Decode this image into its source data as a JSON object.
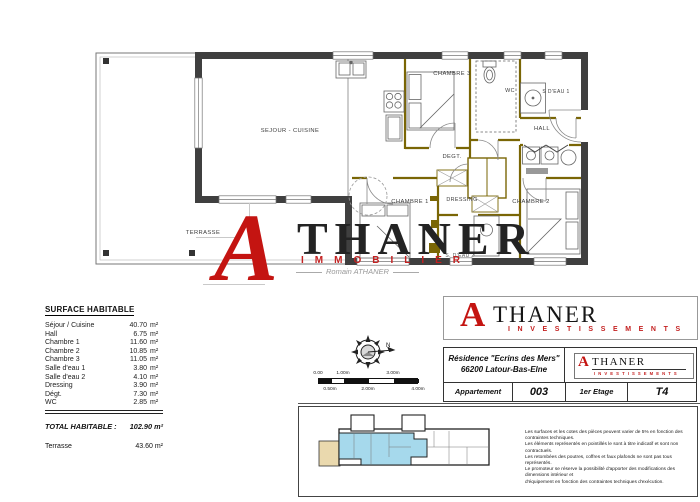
{
  "colors": {
    "accent_red": "#c41411",
    "wall_dark": "#3f3f3f",
    "joinery_gold": "#7a6605",
    "site_plan_blue": "#a6d9ec",
    "site_plan_tan": "#ead9ae"
  },
  "plan": {
    "rooms": {
      "sejour": "SEJOUR - CUISINE",
      "terrasse": "TERRASSE",
      "chambre1": "CHAMBRE 1",
      "chambre2": "CHAMBRE 2",
      "chambre3": "CHAMBRE 3",
      "wc": "WC",
      "sdeau1": "S D'EAU 1",
      "sdeau2": "S. D'EAU 2",
      "hall": "HALL",
      "degt": "DEGT.",
      "dressing": "DRESSING"
    }
  },
  "watermark": {
    "initial": "A",
    "name_rest": "THANER",
    "tagline": "IMMOBILIER",
    "byline": "Romain ATHANER"
  },
  "surface_table": {
    "title": "SURFACE HABITABLE",
    "rows": [
      {
        "label": "Séjour / Cuisine",
        "value": "40.70",
        "unit": "m²"
      },
      {
        "label": "Hall",
        "value": "6.75",
        "unit": "m²"
      },
      {
        "label": "Chambre 1",
        "value": "11.60",
        "unit": "m²"
      },
      {
        "label": "Chambre 2",
        "value": "10.85",
        "unit": "m²"
      },
      {
        "label": "Chambre 3",
        "value": "11.05",
        "unit": "m²"
      },
      {
        "label": "Salle d'eau 1",
        "value": "3.80",
        "unit": "m²"
      },
      {
        "label": "Salle d'eau 2",
        "value": "4.10",
        "unit": "m²"
      },
      {
        "label": "Dressing",
        "value": "3.90",
        "unit": "m²"
      },
      {
        "label": "Dégt.",
        "value": "7.30",
        "unit": "m²"
      },
      {
        "label": "WC",
        "value": "2.85",
        "unit": "m²"
      }
    ],
    "total_label": "TOTAL HABITABLE :",
    "total_value": "102.90 m²",
    "terrace_label": "Terrasse",
    "terrace_value": "43.60 m²"
  },
  "compass": {
    "north": "N"
  },
  "scale_bar": {
    "top_labels": [
      "0.00",
      "1.00m",
      "3.00m"
    ],
    "bottom_labels": [
      "0.50m",
      "2.00m",
      "4.00m"
    ]
  },
  "logo_main": {
    "initial": "A",
    "name_rest": "THANER",
    "subtitle": "INVESTISSEMENTS"
  },
  "title_block": {
    "residence_line1": "Résidence \"Ecrins des Mers\"",
    "residence_line2": "66200 Latour-Bas-Elne",
    "apartment_label": "Appartement",
    "apartment_number": "003",
    "floor_label": "1er Etage",
    "type_label": "T4",
    "logo": {
      "initial": "A",
      "name_rest": "THANER",
      "subtitle": "INVESTISSEMENTS"
    }
  },
  "footer": {
    "legal_lines": [
      "Les surfaces et les cotes des pièces peuvent varier de 5% en fonction des contraintes techniques.",
      "Les éléments représentés en pointillés le sont à titre indicatif et sont non contractuels.",
      "Les retombées des poutres, coffres et faux plafonds ne sont pas tous représentés.",
      "Le promoteur se réserve la possibilité d'apporter des modifications des dimensions intérieur et",
      "d'équipement en fonction des contraintes techniques d'exécution."
    ]
  }
}
